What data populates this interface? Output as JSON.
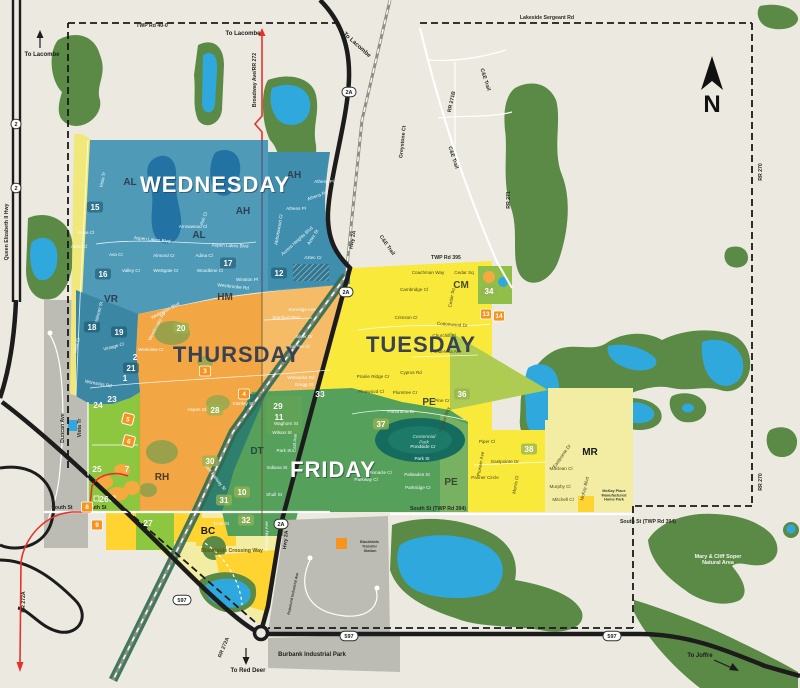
{
  "compass": {
    "label": "N"
  },
  "colors": {
    "background": "#ECEAE0",
    "nature_green": "#5B8A47",
    "lake_blue": "#2FA8DD",
    "wednesday_blue": "#4E9AB7",
    "thursday_orange": "#F3A744",
    "tuesday_yellow": "#F8E93B",
    "friday_green": "#55A05A",
    "pale_yellow": "#F2EDA2",
    "bright_yellow": "#FFD431",
    "light_green": "#8DC63F",
    "industrial_gray": "#BCBCB4",
    "highway_black": "#1C1C1C",
    "route_red": "#E8312A",
    "marker_orange": "#F7941E"
  },
  "zones": [
    {
      "id": "wednesday",
      "label": "WEDNESDAY",
      "color": "#4E9AB7",
      "text_color": "#ffffff"
    },
    {
      "id": "thursday",
      "label": "THURSDAY",
      "color": "#F3A744",
      "text_color": "#3a4252"
    },
    {
      "id": "tuesday",
      "label": "TUESDAY",
      "color": "#F8E93B",
      "text_color": "#3a4252"
    },
    {
      "id": "friday",
      "label": "FRIDAY",
      "color": "#55A05A",
      "text_color": "#ffffff"
    }
  ],
  "legend": {
    "transfer_station": {
      "lines": [
        "Blackfalds",
        "Transfer",
        "Station"
      ],
      "color": "#F7941E"
    }
  },
  "neighborhoods": [
    {
      "code": "AL",
      "x": 130,
      "y": 185,
      "c": "#2f4054"
    },
    {
      "code": "AL",
      "x": 199,
      "y": 238,
      "c": "#2f4054"
    },
    {
      "code": "AH",
      "x": 294,
      "y": 178,
      "c": "#2f4054"
    },
    {
      "code": "AH",
      "x": 243,
      "y": 214,
      "c": "#2f4054"
    },
    {
      "code": "VR",
      "x": 111,
      "y": 302,
      "c": "#2f4054"
    },
    {
      "code": "HM",
      "x": 225,
      "y": 300,
      "c": "#4a3a28"
    },
    {
      "code": "CM",
      "x": 461,
      "y": 288,
      "c": "#4a4a28"
    },
    {
      "code": "PE",
      "x": 429,
      "y": 405,
      "c": "#3a4a30"
    },
    {
      "code": "PE",
      "x": 451,
      "y": 485,
      "c": "#3a4a30"
    },
    {
      "code": "DT",
      "x": 257,
      "y": 454,
      "c": "#234a3c"
    },
    {
      "code": "RH",
      "x": 162,
      "y": 480,
      "c": "#4a3a28"
    },
    {
      "code": "BC",
      "x": 208,
      "y": 534,
      "c": "#1a1a1a"
    },
    {
      "code": "MR",
      "x": 590,
      "y": 455,
      "c": "#1a1a1a"
    }
  ],
  "area_markers": [
    {
      "n": "15",
      "x": 95,
      "y": 207,
      "st": "chip-b"
    },
    {
      "n": "16",
      "x": 103,
      "y": 274,
      "st": "chip-b"
    },
    {
      "n": "17",
      "x": 228,
      "y": 263,
      "st": "chip-b"
    },
    {
      "n": "12",
      "x": 279,
      "y": 273,
      "st": "chip-b"
    },
    {
      "n": "18",
      "x": 92,
      "y": 327,
      "st": "chip-b"
    },
    {
      "n": "19",
      "x": 119,
      "y": 332,
      "st": "chip-b"
    },
    {
      "n": "20",
      "x": 181,
      "y": 328,
      "st": "chip-g"
    },
    {
      "n": "2",
      "x": 135,
      "y": 357,
      "st": "plain"
    },
    {
      "n": "21",
      "x": 131,
      "y": 368,
      "st": "chip-b"
    },
    {
      "n": "1",
      "x": 125,
      "y": 378,
      "st": "plain"
    },
    {
      "n": "3",
      "x": 205,
      "y": 371,
      "st": "box"
    },
    {
      "n": "4",
      "x": 244,
      "y": 394,
      "st": "box"
    },
    {
      "n": "23",
      "x": 112,
      "y": 399,
      "st": "plain"
    },
    {
      "n": "24",
      "x": 98,
      "y": 405,
      "st": "plain"
    },
    {
      "n": "5",
      "x": 128,
      "y": 419,
      "st": "diamond"
    },
    {
      "n": "6",
      "x": 129,
      "y": 441,
      "st": "diamond"
    },
    {
      "n": "25",
      "x": 97,
      "y": 469,
      "st": "plain"
    },
    {
      "n": "7",
      "x": 127,
      "y": 469,
      "st": "plain"
    },
    {
      "n": "26",
      "x": 104,
      "y": 499,
      "st": "plain"
    },
    {
      "n": "8",
      "x": 87,
      "y": 507,
      "st": "box"
    },
    {
      "n": "9",
      "x": 97,
      "y": 525,
      "st": "box"
    },
    {
      "n": "27",
      "x": 148,
      "y": 523,
      "st": "plain"
    },
    {
      "n": "28",
      "x": 215,
      "y": 410,
      "st": "chip-g"
    },
    {
      "n": "29",
      "x": 278,
      "y": 406,
      "st": "plain"
    },
    {
      "n": "11",
      "x": 279,
      "y": 417,
      "st": "plain"
    },
    {
      "n": "33",
      "x": 320,
      "y": 394,
      "st": "plain"
    },
    {
      "n": "37",
      "x": 381,
      "y": 424,
      "st": "chip-g"
    },
    {
      "n": "30",
      "x": 210,
      "y": 461,
      "st": "chip-g"
    },
    {
      "n": "31",
      "x": 224,
      "y": 500,
      "st": "chip-g"
    },
    {
      "n": "10",
      "x": 242,
      "y": 492,
      "st": "chip-g"
    },
    {
      "n": "32",
      "x": 246,
      "y": 520,
      "st": "chip-g"
    },
    {
      "n": "34",
      "x": 489,
      "y": 291,
      "st": "chip-g"
    },
    {
      "n": "13",
      "x": 486,
      "y": 314,
      "st": "box"
    },
    {
      "n": "14",
      "x": 499,
      "y": 316,
      "st": "box"
    },
    {
      "n": "36",
      "x": 462,
      "y": 394,
      "st": "chip-g"
    },
    {
      "n": "38",
      "x": 529,
      "y": 449,
      "st": "chip-g"
    }
  ],
  "shields": [
    {
      "t": "2",
      "x": 16,
      "y": 124
    },
    {
      "t": "2",
      "x": 16,
      "y": 188
    },
    {
      "t": "2A",
      "x": 349,
      "y": 92
    },
    {
      "t": "2A",
      "x": 346,
      "y": 292
    },
    {
      "t": "2A",
      "x": 281,
      "y": 524
    },
    {
      "t": "597",
      "x": 182,
      "y": 600
    },
    {
      "t": "597",
      "x": 349,
      "y": 636
    },
    {
      "t": "597",
      "x": 612,
      "y": 636
    }
  ],
  "labels": [
    {
      "t": "TWP Rd 40-0",
      "x": 152,
      "y": 27,
      "s": "road"
    },
    {
      "t": "Lakeside Sergeant Rd",
      "x": 547,
      "y": 19,
      "s": "road"
    },
    {
      "t": "To Lacombe",
      "x": 42,
      "y": 56,
      "s": "dir"
    },
    {
      "t": "To Lacombe",
      "x": 243,
      "y": 35,
      "s": "dir"
    },
    {
      "t": "To Lacombe",
      "x": 356,
      "y": 46,
      "r": 42,
      "s": "dir"
    },
    {
      "t": "Broadway Ave/RR 272",
      "x": 256,
      "y": 80,
      "r": -90,
      "s": "road"
    },
    {
      "t": "Queen Elizabeth II Hwy",
      "x": 8,
      "y": 232,
      "r": -90,
      "s": "road"
    },
    {
      "t": "C&E Trail",
      "x": 484,
      "y": 80,
      "r": 72,
      "s": "road"
    },
    {
      "t": "C&E Trail",
      "x": 452,
      "y": 158,
      "r": 72,
      "s": "road"
    },
    {
      "t": "C&E Trail",
      "x": 386,
      "y": 246,
      "r": 55,
      "s": "road"
    },
    {
      "t": "RR 271B",
      "x": 453,
      "y": 102,
      "r": -78,
      "s": "road"
    },
    {
      "t": "Greystone Ct",
      "x": 404,
      "y": 142,
      "r": -84,
      "s": "road"
    },
    {
      "t": "RR 270",
      "x": 762,
      "y": 172,
      "r": -90,
      "s": "road"
    },
    {
      "t": "RR 270",
      "x": 762,
      "y": 482,
      "r": -90,
      "s": "road"
    },
    {
      "t": "RR 271",
      "x": 510,
      "y": 200,
      "r": -90,
      "s": "road"
    },
    {
      "t": "TWP Rd 395",
      "x": 446,
      "y": 259,
      "s": "road"
    },
    {
      "t": "Hwy 2A",
      "x": 354,
      "y": 240,
      "r": -80,
      "s": "road"
    },
    {
      "t": "Hwy 2A",
      "x": 287,
      "y": 540,
      "r": -84,
      "s": "road"
    },
    {
      "t": "South St",
      "x": 62,
      "y": 509,
      "s": "road"
    },
    {
      "t": "South St",
      "x": 96,
      "y": 509,
      "s": "road"
    },
    {
      "t": "South St (TWP Rd 394)",
      "x": 438,
      "y": 510,
      "s": "road"
    },
    {
      "t": "South St (TWP Rd 394)",
      "x": 648,
      "y": 523,
      "s": "road"
    },
    {
      "t": "Blackfalds Crossing Way",
      "x": 232,
      "y": 552,
      "s": "road-brown"
    },
    {
      "t": "Burbank Industrial Park",
      "x": 312,
      "y": 656,
      "s": "place"
    },
    {
      "t": "To Red Deer",
      "x": 248,
      "y": 672,
      "s": "dir"
    },
    {
      "t": "To Joffre",
      "x": 700,
      "y": 657,
      "s": "dir"
    },
    {
      "t": "RR 272A",
      "x": 25,
      "y": 602,
      "r": -90,
      "s": "road"
    },
    {
      "t": "RR 272A",
      "x": 225,
      "y": 648,
      "r": -68,
      "s": "road"
    },
    {
      "t": "Duncan Ave",
      "x": 64,
      "y": 428,
      "r": -90,
      "s": "road"
    },
    {
      "t": "Vista Tr",
      "x": 81,
      "y": 428,
      "r": -90,
      "s": "road"
    },
    {
      "t": "Vista Tr",
      "x": 104,
      "y": 180,
      "r": -78,
      "s": "st-w"
    },
    {
      "t": "East Railway St",
      "x": 214,
      "y": 478,
      "r": 52,
      "s": "st-w"
    },
    {
      "t": "Broadway Ave",
      "x": 268,
      "y": 536,
      "r": -90,
      "s": "st-w"
    },
    {
      "ln": [
        "Mary & Cliff Soper",
        "Natural Area"
      ],
      "x": 718,
      "y": 558,
      "s": "place-w"
    },
    {
      "t": "Aspelund Industrial Ave",
      "x": 294,
      "y": 594,
      "r": -78,
      "s": "tiny"
    },
    {
      "ln": [
        "McKay Place",
        "Manufactured",
        "Home Park"
      ],
      "x": 614,
      "y": 492,
      "s": "tiny"
    },
    {
      "ln": [
        "Centennial",
        "Park"
      ],
      "x": 424,
      "y": 438,
      "s": "park"
    },
    {
      "t": "Anna Cl",
      "x": 86,
      "y": 234,
      "s": "st-w"
    },
    {
      "t": "Arlen Cl",
      "x": 79,
      "y": 248,
      "s": "st-w"
    },
    {
      "t": "Ava Cr",
      "x": 116,
      "y": 256,
      "s": "st-w"
    },
    {
      "t": "Aspen Lakes Blvd",
      "x": 152,
      "y": 241,
      "r": 6,
      "s": "st-w"
    },
    {
      "t": "Aspen Lakes Blvd",
      "x": 230,
      "y": 247,
      "r": 2,
      "s": "st-w"
    },
    {
      "t": "Valley Cr",
      "x": 131,
      "y": 272,
      "s": "st-w"
    },
    {
      "t": "Westgate Cr",
      "x": 166,
      "y": 272,
      "s": "st-w"
    },
    {
      "t": "Almond Cr",
      "x": 164,
      "y": 257,
      "s": "st-w"
    },
    {
      "t": "Adina Cl",
      "x": 204,
      "y": 257,
      "s": "st-w"
    },
    {
      "t": "Woodbine Cl",
      "x": 210,
      "y": 272,
      "s": "st-w"
    },
    {
      "t": "Winston Pl",
      "x": 247,
      "y": 281,
      "s": "st-w"
    },
    {
      "t": "Westbrooke Rd",
      "x": 233,
      "y": 288,
      "r": 6,
      "s": "st-w"
    },
    {
      "t": "Westbrooke Rd",
      "x": 158,
      "y": 327,
      "r": -62,
      "s": "st-w"
    },
    {
      "t": "Arrowwood Cl",
      "x": 193,
      "y": 228,
      "s": "st-w"
    },
    {
      "t": "Ash Cl",
      "x": 205,
      "y": 219,
      "r": -70,
      "s": "st-w"
    },
    {
      "t": "Valmont St",
      "x": 100,
      "y": 313,
      "r": -75,
      "s": "st-w"
    },
    {
      "t": "Vintage Cl",
      "x": 114,
      "y": 348,
      "r": -15,
      "s": "st-w"
    },
    {
      "t": "Vista Cl",
      "x": 78,
      "y": 346,
      "r": -75,
      "s": "st-w"
    },
    {
      "t": "Womacks Rd",
      "x": 98,
      "y": 385,
      "r": 10,
      "s": "st-w"
    },
    {
      "t": "Athens Pl",
      "x": 324,
      "y": 183,
      "s": "st-w"
    },
    {
      "t": "Athens Rd",
      "x": 318,
      "y": 197,
      "r": -20,
      "s": "st-w"
    },
    {
      "t": "Athens Pl",
      "x": 296,
      "y": 210,
      "s": "st-w"
    },
    {
      "t": "Aurora Heights Blvd",
      "x": 298,
      "y": 242,
      "r": -42,
      "s": "st-w"
    },
    {
      "t": "Aztec St",
      "x": 314,
      "y": 238,
      "r": -58,
      "s": "st-w"
    },
    {
      "t": "Aztec Cr",
      "x": 313,
      "y": 259,
      "s": "st-w"
    },
    {
      "t": "Abbotswood Cl",
      "x": 280,
      "y": 230,
      "r": -80,
      "s": "st-w"
    },
    {
      "t": "Wellington Blvd",
      "x": 166,
      "y": 312,
      "r": -28,
      "s": "st-w"
    },
    {
      "t": "Stanford Blvd",
      "x": 286,
      "y": 319,
      "s": "st-w"
    },
    {
      "t": "Sunridge Ave",
      "x": 302,
      "y": 311,
      "s": "st-w"
    },
    {
      "t": "Silver Dr",
      "x": 304,
      "y": 338,
      "s": "st-w"
    },
    {
      "t": "Sunrise Cl",
      "x": 299,
      "y": 348,
      "s": "st-w"
    },
    {
      "t": "Westview Cr",
      "x": 151,
      "y": 351,
      "s": "st-w"
    },
    {
      "t": "Womacks Rd",
      "x": 301,
      "y": 379,
      "s": "st-w"
    },
    {
      "t": "Gregg St",
      "x": 304,
      "y": 386,
      "s": "st-w"
    },
    {
      "t": "Stanley St",
      "x": 243,
      "y": 405,
      "s": "st-w"
    },
    {
      "t": "Aspen Dr",
      "x": 197,
      "y": 411,
      "s": "st-w"
    },
    {
      "t": "Waghorn St",
      "x": 286,
      "y": 425,
      "s": "st-w"
    },
    {
      "t": "Wilson St",
      "x": 282,
      "y": 434,
      "s": "st-w"
    },
    {
      "t": "Park St",
      "x": 284,
      "y": 452,
      "s": "st-w"
    },
    {
      "t": "Indiana St",
      "x": 277,
      "y": 469,
      "s": "st-w"
    },
    {
      "t": "Shull St",
      "x": 274,
      "y": 496,
      "s": "st-w"
    },
    {
      "t": "East Ave",
      "x": 296,
      "y": 443,
      "r": -85,
      "s": "st-w"
    },
    {
      "t": "Panorama Dr",
      "x": 401,
      "y": 413,
      "s": "st-w"
    },
    {
      "t": "Pondside Cr",
      "x": 423,
      "y": 448,
      "s": "st-w"
    },
    {
      "t": "Park St",
      "x": 422,
      "y": 460,
      "s": "st-w"
    },
    {
      "t": "Palisades St",
      "x": 417,
      "y": 476,
      "s": "st-w"
    },
    {
      "t": "Parkridge Cr",
      "x": 418,
      "y": 489,
      "s": "st-w"
    },
    {
      "t": "Pinnacle Cl",
      "x": 380,
      "y": 474,
      "s": "st-w"
    },
    {
      "t": "Parkway Cl",
      "x": 366,
      "y": 481,
      "s": "st-w"
    },
    {
      "t": "Trout St",
      "x": 221,
      "y": 525,
      "s": "st-w"
    },
    {
      "t": "Coachman Way",
      "x": 428,
      "y": 274,
      "s": "st-d"
    },
    {
      "t": "Cedar Sq",
      "x": 464,
      "y": 274,
      "s": "st-d"
    },
    {
      "t": "Cedar Sq",
      "x": 453,
      "y": 298,
      "r": -80,
      "s": "st-d"
    },
    {
      "t": "Cambridge Cl",
      "x": 414,
      "y": 291,
      "s": "st-d"
    },
    {
      "t": "Crimson Cl",
      "x": 406,
      "y": 319,
      "s": "st-d"
    },
    {
      "t": "Cottonwood Dr",
      "x": 452,
      "y": 326,
      "r": 4,
      "s": "st-d"
    },
    {
      "t": "Churchill Pl",
      "x": 444,
      "y": 337,
      "s": "st-d"
    },
    {
      "t": "Ponderosa Ave",
      "x": 446,
      "y": 353,
      "s": "st-d"
    },
    {
      "t": "Cyprus Rd",
      "x": 411,
      "y": 374,
      "s": "st-d"
    },
    {
      "t": "Pine Cr",
      "x": 442,
      "y": 402,
      "s": "st-d"
    },
    {
      "t": "Plumtree Cr",
      "x": 405,
      "y": 394,
      "s": "st-d"
    },
    {
      "t": "Pinewood Cl",
      "x": 371,
      "y": 393,
      "s": "st-d"
    },
    {
      "t": "Prairie Ridge Cr",
      "x": 373,
      "y": 378,
      "s": "st-d"
    },
    {
      "t": "Pioneer Way",
      "x": 446,
      "y": 420,
      "r": -72,
      "s": "st-d"
    },
    {
      "t": "Piper Cl",
      "x": 487,
      "y": 443,
      "s": "st-d"
    },
    {
      "t": "Pioneer Ave",
      "x": 482,
      "y": 464,
      "r": -80,
      "s": "st-d"
    },
    {
      "t": "Eastpointe Dr",
      "x": 505,
      "y": 463,
      "s": "st-d"
    },
    {
      "t": "Eastpointe Dr",
      "x": 563,
      "y": 457,
      "r": -55,
      "s": "st-d"
    },
    {
      "t": "Palmer Circle",
      "x": 485,
      "y": 479,
      "s": "st-d"
    },
    {
      "t": "Maclean Cl",
      "x": 561,
      "y": 470,
      "s": "st-d"
    },
    {
      "t": "Murphy Cl",
      "x": 560,
      "y": 488,
      "s": "st-d"
    },
    {
      "t": "Mitchell Cl",
      "x": 563,
      "y": 501,
      "s": "st-d"
    },
    {
      "t": "Morris Cl",
      "x": 517,
      "y": 485,
      "r": -80,
      "s": "st-d"
    },
    {
      "t": "McKay Blvd",
      "x": 586,
      "y": 489,
      "r": -76,
      "s": "st-d"
    }
  ]
}
